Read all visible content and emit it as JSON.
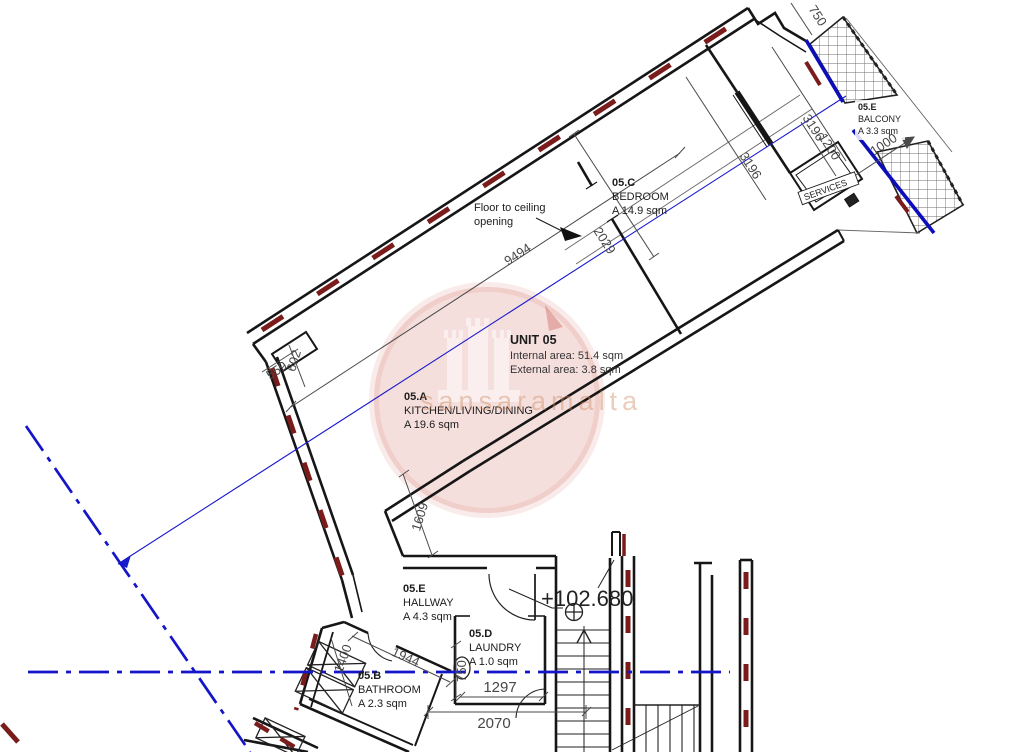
{
  "unit": {
    "title": "UNIT 05",
    "internal": "Internal area: 51.4 sqm",
    "external": "External area: 3.8 sqm"
  },
  "rooms": {
    "kitchen": {
      "code": "05.A",
      "name": "KITCHEN/LIVING/DINING",
      "area": "A 19.6 sqm"
    },
    "bathroom": {
      "code": "05.B",
      "name": "BATHROOM",
      "area": "A 2.3 sqm"
    },
    "bedroom": {
      "code": "05.C",
      "name": "BEDROOM",
      "area": "A 14.9 sqm"
    },
    "laundry": {
      "code": "05.D",
      "name": "LAUNDRY",
      "area": "A 1.0 sqm"
    },
    "hallway": {
      "code": "05.E",
      "name": "HALLWAY",
      "area": "A 4.3 sqm"
    },
    "balcony": {
      "code": "05.E",
      "name": "BALCONY",
      "area": "A 3.3 sqm"
    }
  },
  "annotations": {
    "floor_opening_1": "Floor to ceiling",
    "floor_opening_2": "opening",
    "services": "SERVICES",
    "level": "+102.680"
  },
  "dimensions": {
    "top_750": "750",
    "balcony_3196": "3196",
    "bedroom_3196": "3196",
    "services_1200": "1200",
    "balcony_1000": "1000",
    "bedroom_2029": "2029",
    "living_9494": "9494",
    "niche_602": "602",
    "niche_559": "559",
    "step_1609": "1609",
    "bath_1400": "1400",
    "bath_1944": "1944",
    "laundry_750": "750",
    "laundry_1297": "1297",
    "stairs_2070": "2070"
  },
  "watermark": {
    "text": "sansaramalta"
  },
  "colors": {
    "wall": "#161616",
    "insulation_red": "#7a1c1c",
    "reference_blue": "#1414c8",
    "dimension_gray": "#474747",
    "watermark_red": "#c0392b",
    "watermark_text": "#cf8a5e"
  }
}
